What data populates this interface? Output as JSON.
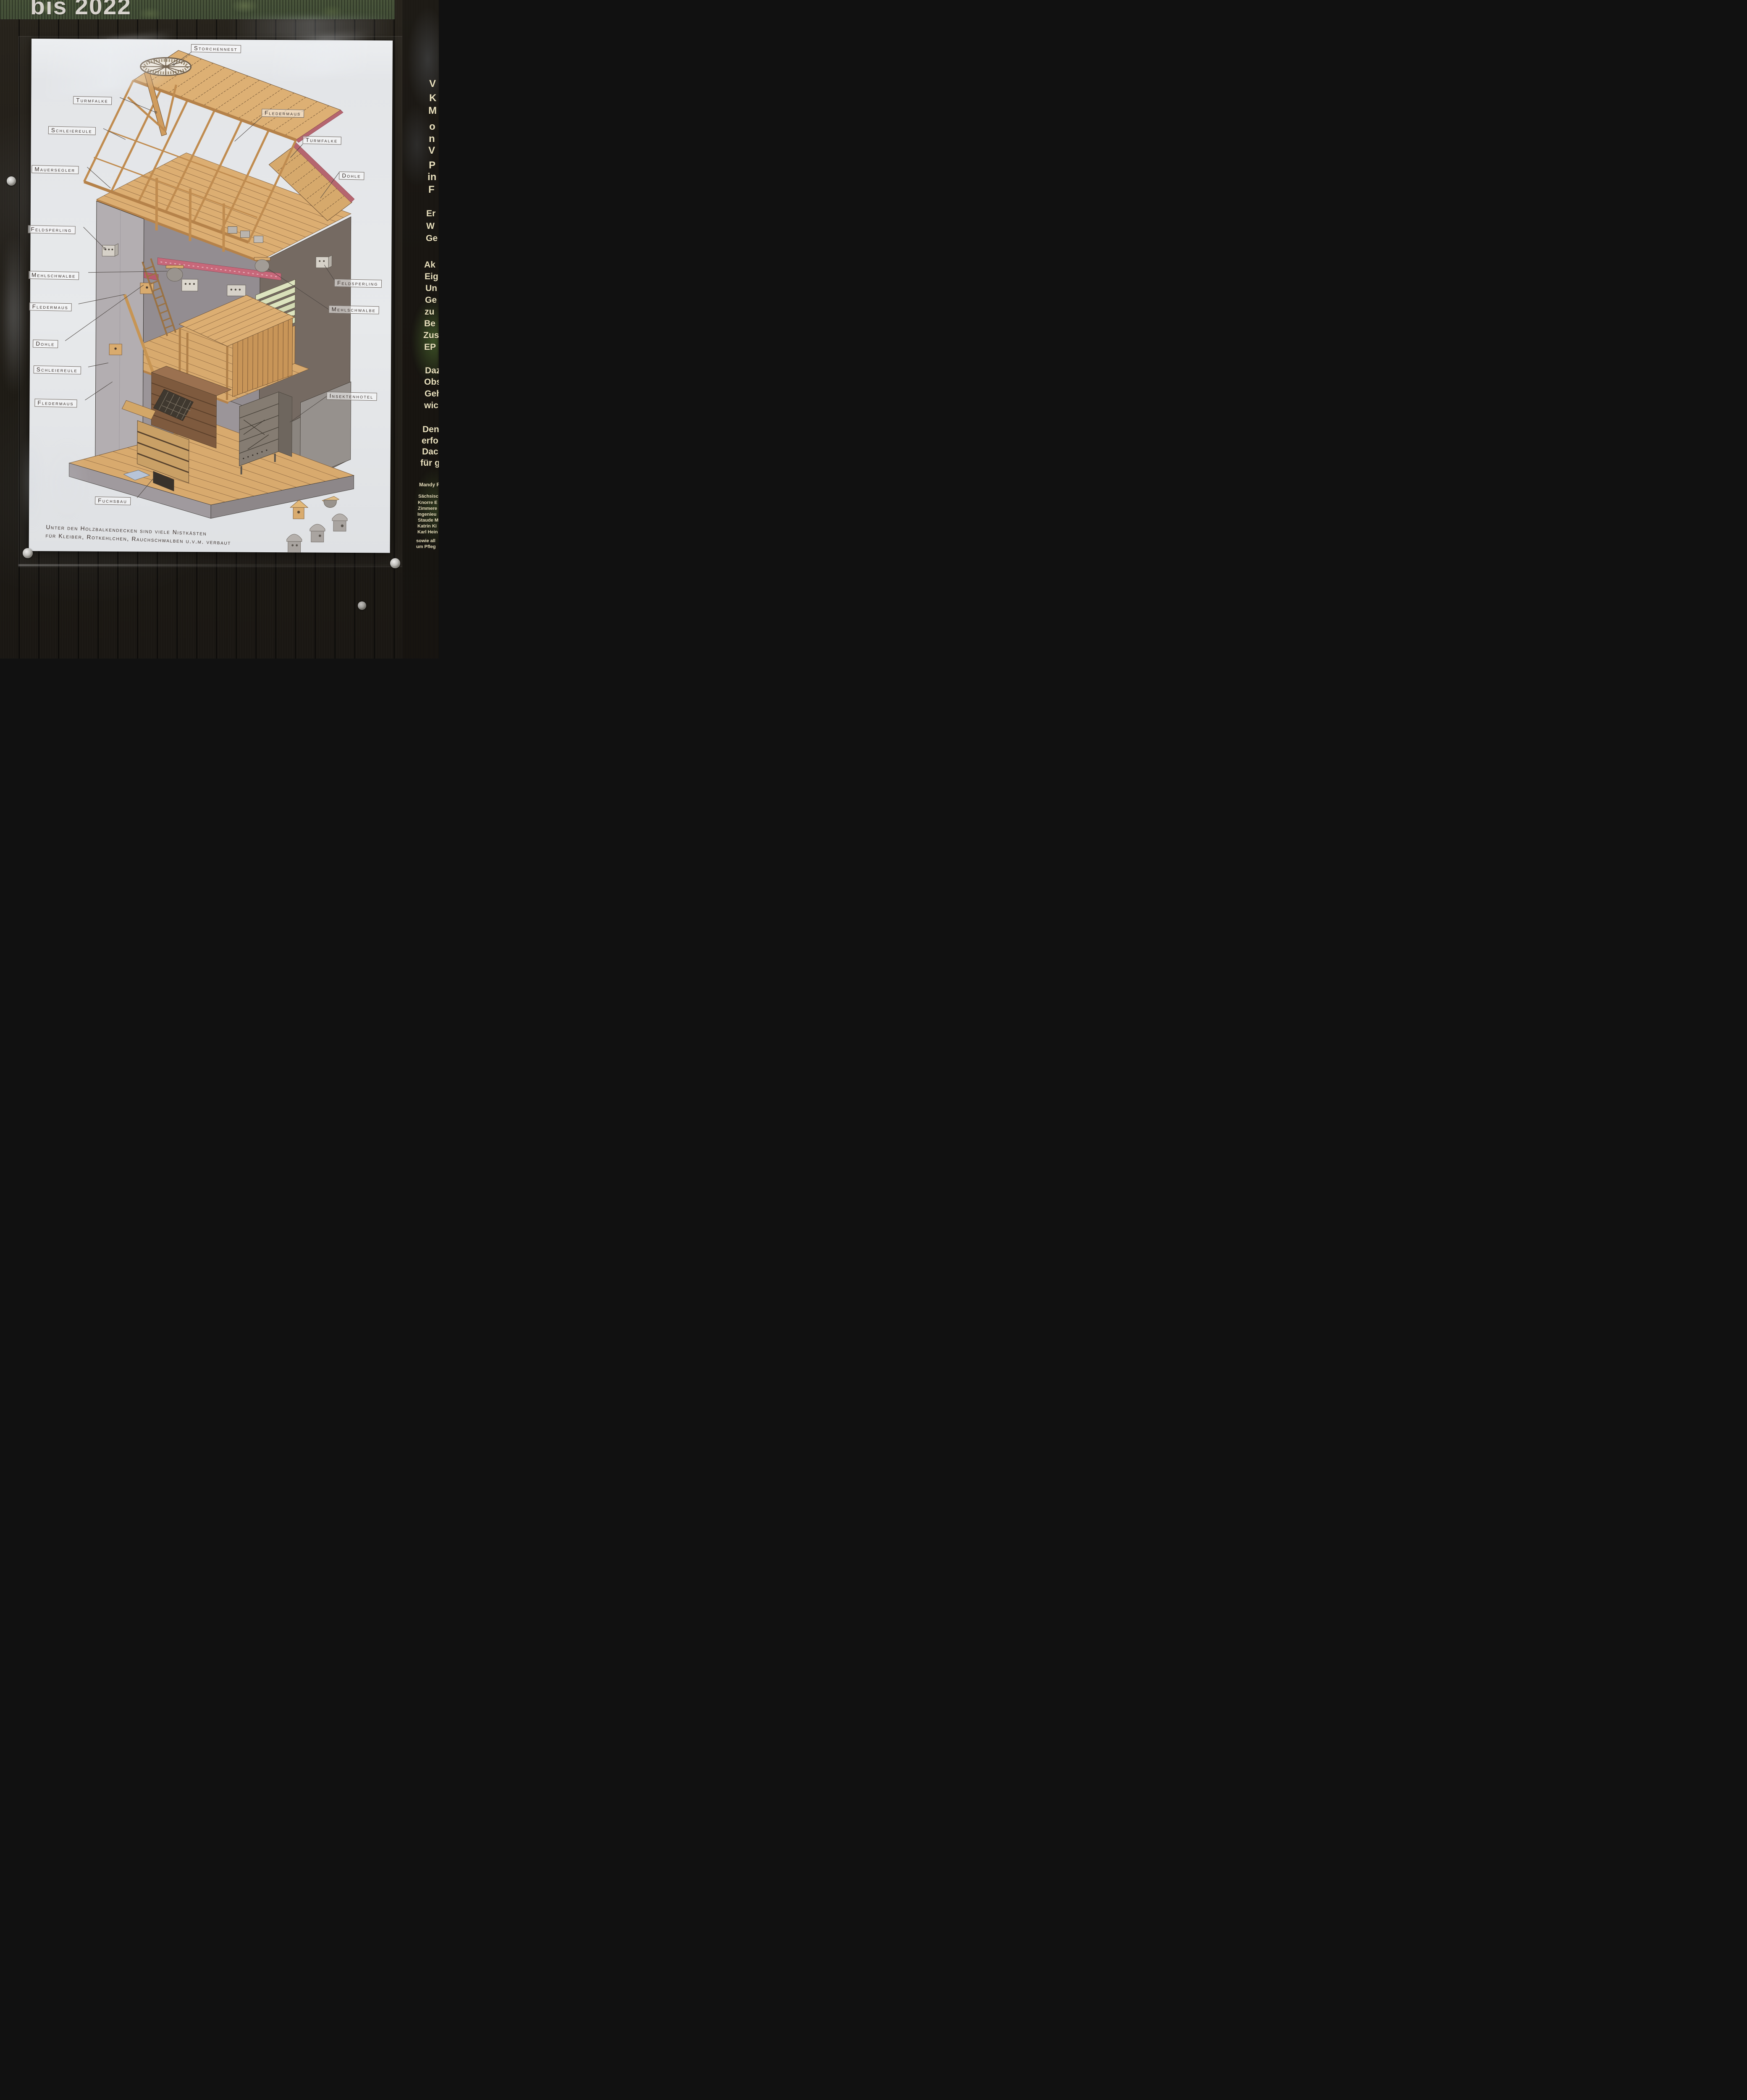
{
  "banner": {
    "title": "bis 2022"
  },
  "poster": {
    "labels": [
      {
        "id": "storchennest",
        "text": "Storchennest"
      },
      {
        "id": "turmfalke-1",
        "text": "Turmfalke"
      },
      {
        "id": "schleiereule-1",
        "text": "Schleiereule"
      },
      {
        "id": "fledermaus-1",
        "text": "Fledermaus"
      },
      {
        "id": "turmfalke-2",
        "text": "Turmfalke"
      },
      {
        "id": "mauersegler",
        "text": "Mauersegler"
      },
      {
        "id": "dohle-2",
        "text": "Dohle"
      },
      {
        "id": "feldsperling-1",
        "text": "Feldsperling"
      },
      {
        "id": "mehlschwalbe-1",
        "text": "Mehlschwalbe"
      },
      {
        "id": "fledermaus-2",
        "text": "Fledermaus"
      },
      {
        "id": "dohle-1",
        "text": "Dohle"
      },
      {
        "id": "schleiereule-2",
        "text": "Schleiereule"
      },
      {
        "id": "fledermaus-3",
        "text": "Fledermaus"
      },
      {
        "id": "feldsperling-2",
        "text": "Feldsperling"
      },
      {
        "id": "mehlschwalbe-2",
        "text": "Mehlschwalbe"
      },
      {
        "id": "insektenhotel",
        "text": "Insektenhotel"
      },
      {
        "id": "fuchsbau",
        "text": "Fuchsbau"
      }
    ],
    "caption": {
      "line1": "Unter den Holzbalkendecken sind viele Nistkästen",
      "line2": "für Kleiber, Rotkehlchen, Rauchschwalben u.v.m. verbaut"
    }
  },
  "side_panel": {
    "fragments": [
      {
        "text": "V"
      },
      {
        "text": "K"
      },
      {
        "text": "M"
      },
      {
        "text": "o"
      },
      {
        "text": "n"
      },
      {
        "text": "V"
      },
      {
        "text": "P"
      },
      {
        "text": "in"
      },
      {
        "text": "F"
      },
      {
        "text": "Er"
      },
      {
        "text": "W"
      },
      {
        "text": "Ge"
      },
      {
        "text": "Ak"
      },
      {
        "text": "Eig"
      },
      {
        "text": "Un"
      },
      {
        "text": "Ge"
      },
      {
        "text": "zu"
      },
      {
        "text": "Be"
      },
      {
        "text": "Zus"
      },
      {
        "text": "EP"
      },
      {
        "text": "Daz"
      },
      {
        "text": "Obs"
      },
      {
        "text": "Geh"
      },
      {
        "text": "wic"
      },
      {
        "text": "Den"
      },
      {
        "text": "erfo"
      },
      {
        "text": "Dac"
      },
      {
        "text": "für g"
      },
      {
        "text": "Mandy F"
      },
      {
        "text": "Sächsisc"
      },
      {
        "text": "Knorre E"
      },
      {
        "text": "Zimmere"
      },
      {
        "text": "Ingenieu"
      },
      {
        "text": "Staude M"
      },
      {
        "text": "Katrin Ki"
      },
      {
        "text": "Karl Hein"
      },
      {
        "text": "sowie all"
      },
      {
        "text": "um Pfleg"
      }
    ]
  },
  "colors": {
    "wood_light": "#dcae72",
    "wood_mid": "#c08c50",
    "wood_dark": "#7e5a3e",
    "wall_grey": "#b3aeb1",
    "wall_umber": "#756a62",
    "beam_pink": "#c7687a",
    "louver_green": "#dde4bf",
    "roof_red": "#b5656f",
    "panel_text": "#e9e0bd"
  }
}
